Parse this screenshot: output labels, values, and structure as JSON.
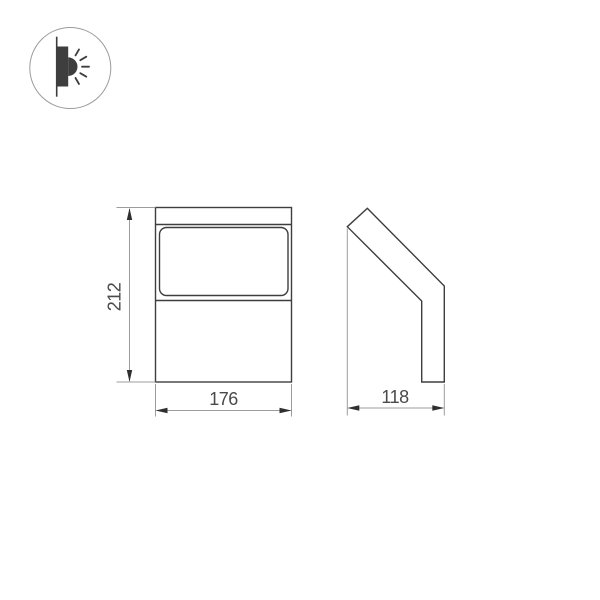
{
  "drawing": {
    "title": "wall luminaire dimensional drawing",
    "dimensions": {
      "height": "212",
      "width": "176",
      "depth": "118"
    },
    "views": [
      "front",
      "side"
    ]
  },
  "icons": {
    "wall_light": "wall-light-direction-icon"
  },
  "colors": {
    "background": "#ffffff",
    "outline": "#3e3e3e",
    "dimension_line": "#9c9c9c",
    "arrow": "#2f2f2f",
    "dimension_text": "#4a4a4a",
    "icon_circle_border": "#9c9c9c"
  }
}
